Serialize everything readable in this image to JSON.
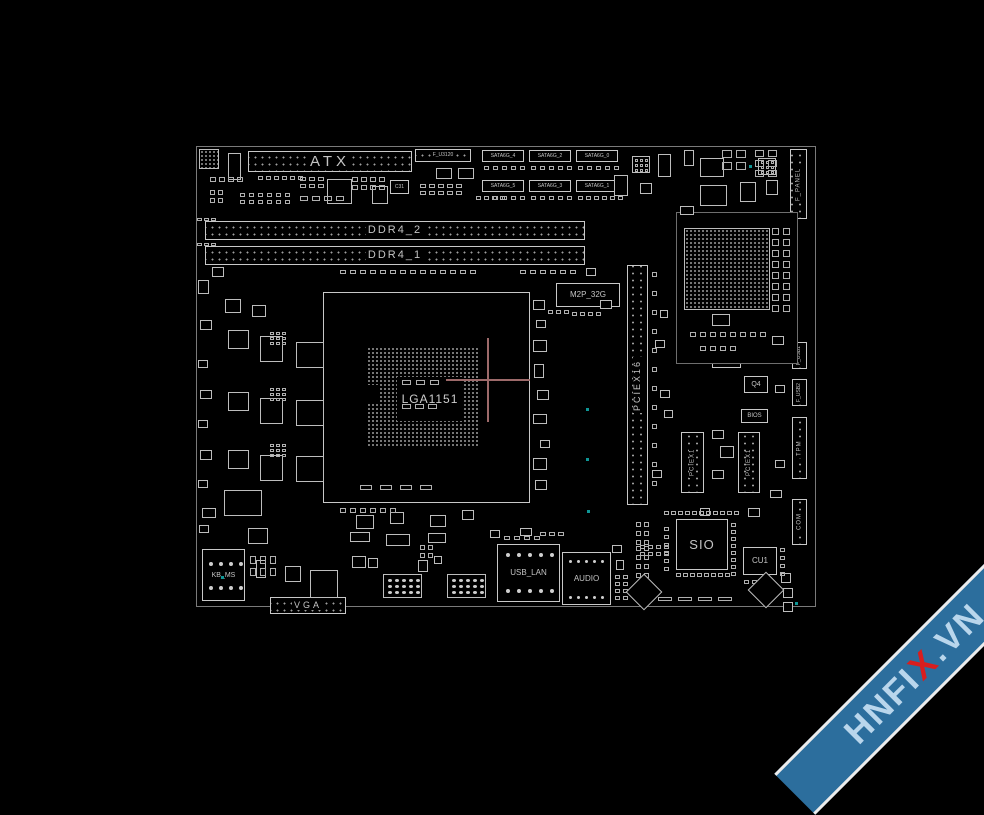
{
  "socket": {
    "label": "LGA1151"
  },
  "watermark": {
    "pre": "HNFI",
    "x": "X",
    "post": ".VN"
  },
  "crosshair": {
    "x": 488,
    "y": 380,
    "arm": 42
  },
  "colors": {
    "background": "#000000",
    "line": "#c8c8c8",
    "dim_line": "#7a7a7a",
    "label": "#c4c4c4",
    "teal": "#0e9696",
    "crosshair": "#9d6a6a",
    "banner": "#2c6e9d",
    "banner_text": "#b9d6ec",
    "banner_x": "#d81e1e",
    "banner_edge": "#ececec"
  },
  "components": [
    {
      "n": "atx-connector",
      "l": "ATX",
      "x": 248,
      "y": 151,
      "w": 164,
      "h": 21,
      "fs": 15,
      "ls": 4,
      "k": "h"
    },
    {
      "n": "f-u3120-header",
      "l": "F_U3120",
      "x": 415,
      "y": 149,
      "w": 56,
      "h": 13,
      "fs": 5,
      "ls": 0,
      "k": "h"
    },
    {
      "n": "sata6g-4-connector",
      "l": "SATA6G_4",
      "x": 482,
      "y": 150,
      "w": 42,
      "h": 12,
      "fs": 5,
      "ls": 0,
      "k": "t"
    },
    {
      "n": "sata6g-2-connector",
      "l": "SATA6G_2",
      "x": 529,
      "y": 150,
      "w": 42,
      "h": 12,
      "fs": 5,
      "ls": 0,
      "k": "t"
    },
    {
      "n": "sata6g-0-connector",
      "l": "SATA6G_0",
      "x": 576,
      "y": 150,
      "w": 42,
      "h": 12,
      "fs": 5,
      "ls": 0,
      "k": "t"
    },
    {
      "n": "sata6g-5-connector",
      "l": "SATA6G_5",
      "x": 482,
      "y": 180,
      "w": 42,
      "h": 12,
      "fs": 5,
      "ls": 0,
      "k": "t"
    },
    {
      "n": "sata6g-3-connector",
      "l": "SATA6G_3",
      "x": 529,
      "y": 180,
      "w": 42,
      "h": 12,
      "fs": 5,
      "ls": 0,
      "k": "t"
    },
    {
      "n": "sata6g-1-connector",
      "l": "SATA6G_1",
      "x": 576,
      "y": 180,
      "w": 42,
      "h": 12,
      "fs": 5,
      "ls": 0,
      "k": "t"
    },
    {
      "n": "ddr4-2-slot",
      "l": "DDR4_2",
      "x": 205,
      "y": 221,
      "w": 380,
      "h": 19,
      "fs": 11,
      "ls": 2,
      "k": "h"
    },
    {
      "n": "ddr4-1-slot",
      "l": "DDR4_1",
      "x": 205,
      "y": 246,
      "w": 380,
      "h": 19,
      "fs": 11,
      "ls": 2,
      "k": "h"
    },
    {
      "n": "m2p-32g-slot",
      "l": "M2P_32G",
      "x": 556,
      "y": 283,
      "w": 64,
      "h": 24,
      "fs": 8,
      "ls": 0,
      "k": "c"
    },
    {
      "n": "pciex16-slot",
      "l": "PCIEX16",
      "x": 627,
      "y": 265,
      "w": 21,
      "h": 240,
      "fs": 9,
      "ls": 2,
      "k": "v"
    },
    {
      "n": "pciex1-1-slot",
      "l": "PCIEX1",
      "x": 681,
      "y": 432,
      "w": 23,
      "h": 61,
      "fs": 6,
      "ls": 1,
      "k": "v"
    },
    {
      "n": "pciex1-2-slot",
      "l": "PCIEX1",
      "x": 738,
      "y": 432,
      "w": 22,
      "h": 61,
      "fs": 6,
      "ls": 1,
      "k": "v"
    },
    {
      "n": "nx2-chip",
      "l": "NX2",
      "x": 712,
      "y": 344,
      "w": 29,
      "h": 24,
      "fs": 7,
      "ls": 0,
      "k": "c"
    },
    {
      "n": "q4-component",
      "l": "Q4",
      "x": 744,
      "y": 376,
      "w": 24,
      "h": 17,
      "fs": 7,
      "ls": 0,
      "k": "c"
    },
    {
      "n": "bios-chip",
      "l": "BIOS",
      "x": 741,
      "y": 409,
      "w": 27,
      "h": 14,
      "fs": 6,
      "ls": 0,
      "k": "c"
    },
    {
      "n": "f-panel-header",
      "l": "F_PANEL",
      "x": 790,
      "y": 149,
      "w": 17,
      "h": 70,
      "fs": 6,
      "ls": 1,
      "k": "v"
    },
    {
      "n": "f-usb1-header",
      "l": "F_USB1",
      "x": 792,
      "y": 342,
      "w": 15,
      "h": 27,
      "fs": 5,
      "ls": 0,
      "k": "v"
    },
    {
      "n": "f-usb2-header",
      "l": "F_USB2",
      "x": 792,
      "y": 379,
      "w": 15,
      "h": 27,
      "fs": 5,
      "ls": 0,
      "k": "v"
    },
    {
      "n": "tpm-header",
      "l": "TPM",
      "x": 792,
      "y": 417,
      "w": 15,
      "h": 62,
      "fs": 6,
      "ls": 1,
      "k": "v"
    },
    {
      "n": "com-header",
      "l": "COM",
      "x": 792,
      "y": 499,
      "w": 15,
      "h": 46,
      "fs": 6,
      "ls": 1,
      "k": "v"
    },
    {
      "n": "sio-chip",
      "l": "SIO",
      "x": 676,
      "y": 519,
      "w": 52,
      "h": 51,
      "fs": 13,
      "ls": 1,
      "k": "c"
    },
    {
      "n": "cu1-chip",
      "l": "CU1",
      "x": 743,
      "y": 547,
      "w": 34,
      "h": 28,
      "fs": 8,
      "ls": 0,
      "k": "c"
    },
    {
      "n": "kb-ms-connector",
      "l": "KB_MS",
      "x": 202,
      "y": 549,
      "w": 43,
      "h": 52,
      "fs": 7,
      "ls": 0,
      "k": "c"
    },
    {
      "n": "vga-connector",
      "l": "VGA",
      "x": 270,
      "y": 597,
      "w": 76,
      "h": 17,
      "fs": 9,
      "ls": 3,
      "k": "h"
    },
    {
      "n": "usb-lan-connector",
      "l": "USB_LAN",
      "x": 497,
      "y": 544,
      "w": 63,
      "h": 58,
      "fs": 8,
      "ls": 0,
      "k": "c"
    },
    {
      "n": "audio-connector",
      "l": "AUDIO",
      "x": 562,
      "y": 552,
      "w": 49,
      "h": 53,
      "fs": 8,
      "ls": 0,
      "k": "c"
    },
    {
      "n": "c31-component",
      "l": "C31",
      "x": 390,
      "y": 180,
      "w": 19,
      "h": 14,
      "fs": 5,
      "ls": 0,
      "k": "c"
    }
  ],
  "filler": {
    "boxes": [
      [
        199,
        149,
        20,
        20,
        2
      ],
      [
        228,
        153,
        13,
        27,
        0
      ],
      [
        327,
        179,
        25,
        25,
        0
      ],
      [
        372,
        186,
        16,
        18,
        0
      ],
      [
        436,
        168,
        16,
        11,
        0
      ],
      [
        458,
        168,
        16,
        11,
        0
      ],
      [
        614,
        175,
        14,
        21,
        0
      ],
      [
        640,
        183,
        12,
        11,
        0
      ],
      [
        658,
        154,
        13,
        23,
        0
      ],
      [
        632,
        156,
        18,
        17,
        0
      ],
      [
        758,
        158,
        18,
        17,
        0
      ],
      [
        700,
        158,
        24,
        19,
        0
      ],
      [
        740,
        182,
        16,
        20,
        0
      ],
      [
        766,
        180,
        12,
        15,
        0
      ],
      [
        700,
        185,
        27,
        21,
        0
      ],
      [
        676,
        212,
        122,
        152,
        1
      ],
      [
        684,
        228,
        86,
        82,
        2
      ],
      [
        712,
        314,
        18,
        12,
        0
      ],
      [
        680,
        206,
        14,
        9,
        0
      ],
      [
        212,
        267,
        12,
        10,
        0
      ],
      [
        198,
        280,
        11,
        14,
        0
      ],
      [
        225,
        299,
        16,
        14,
        0
      ],
      [
        252,
        305,
        14,
        12,
        0
      ],
      [
        228,
        330,
        21,
        19,
        0
      ],
      [
        260,
        336,
        23,
        26,
        0
      ],
      [
        296,
        342,
        28,
        26,
        0
      ],
      [
        228,
        392,
        21,
        19,
        0
      ],
      [
        260,
        398,
        23,
        26,
        0
      ],
      [
        296,
        400,
        28,
        26,
        0
      ],
      [
        228,
        450,
        21,
        19,
        0
      ],
      [
        260,
        455,
        23,
        26,
        0
      ],
      [
        296,
        456,
        28,
        26,
        0
      ],
      [
        224,
        490,
        38,
        26,
        0
      ],
      [
        248,
        528,
        20,
        16,
        0
      ],
      [
        310,
        570,
        28,
        28,
        0
      ],
      [
        533,
        300,
        12,
        10,
        0
      ],
      [
        536,
        320,
        10,
        8,
        0
      ],
      [
        533,
        340,
        14,
        12,
        0
      ],
      [
        534,
        364,
        10,
        14,
        0
      ],
      [
        537,
        390,
        12,
        10,
        0
      ],
      [
        533,
        414,
        14,
        10,
        0
      ],
      [
        540,
        440,
        10,
        8,
        0
      ],
      [
        533,
        458,
        14,
        12,
        0
      ],
      [
        535,
        480,
        12,
        10,
        0
      ],
      [
        356,
        515,
        18,
        14,
        0
      ],
      [
        390,
        512,
        14,
        12,
        0
      ],
      [
        430,
        515,
        16,
        12,
        0
      ],
      [
        462,
        510,
        12,
        10,
        0
      ],
      [
        350,
        532,
        20,
        10,
        0
      ],
      [
        386,
        534,
        24,
        12,
        0
      ],
      [
        428,
        533,
        18,
        10,
        0
      ],
      [
        660,
        390,
        10,
        8,
        0
      ],
      [
        664,
        410,
        9,
        8,
        0
      ],
      [
        652,
        470,
        10,
        8,
        0
      ],
      [
        712,
        430,
        12,
        9,
        0
      ],
      [
        712,
        470,
        12,
        9,
        0
      ],
      [
        720,
        446,
        14,
        12,
        0
      ],
      [
        612,
        545,
        10,
        8,
        0
      ],
      [
        616,
        560,
        8,
        10,
        0
      ],
      [
        490,
        530,
        10,
        8,
        0
      ],
      [
        520,
        528,
        12,
        8,
        0
      ],
      [
        285,
        566,
        16,
        16,
        0
      ],
      [
        256,
        560,
        10,
        18,
        0
      ],
      [
        352,
        556,
        14,
        12,
        0
      ],
      [
        368,
        558,
        10,
        10,
        0
      ],
      [
        418,
        560,
        10,
        12,
        0
      ],
      [
        434,
        556,
        8,
        8,
        0
      ],
      [
        781,
        573,
        10,
        10,
        0
      ],
      [
        783,
        588,
        10,
        10,
        0
      ],
      [
        783,
        602,
        10,
        10,
        0
      ],
      [
        684,
        150,
        10,
        16,
        0
      ],
      [
        200,
        320,
        12,
        10,
        0
      ],
      [
        198,
        360,
        10,
        8,
        0
      ],
      [
        200,
        390,
        12,
        9,
        0
      ],
      [
        198,
        420,
        10,
        8,
        0
      ],
      [
        200,
        450,
        12,
        10,
        0
      ],
      [
        198,
        480,
        10,
        8,
        0
      ],
      [
        202,
        508,
        14,
        10,
        0
      ],
      [
        199,
        525,
        10,
        8,
        0
      ],
      [
        586,
        268,
        10,
        8,
        0
      ],
      [
        600,
        300,
        12,
        9,
        0
      ],
      [
        655,
        340,
        10,
        8,
        0
      ],
      [
        660,
        310,
        8,
        8,
        0
      ],
      [
        772,
        336,
        12,
        9,
        0
      ],
      [
        775,
        385,
        10,
        8,
        0
      ],
      [
        775,
        460,
        10,
        8,
        0
      ],
      [
        770,
        490,
        12,
        8,
        0
      ],
      [
        748,
        508,
        12,
        9,
        0
      ],
      [
        700,
        508,
        10,
        8,
        0
      ],
      [
        383,
        574,
        39,
        24,
        0
      ],
      [
        447,
        574,
        39,
        24,
        0
      ]
    ],
    "grids": [
      [
        210,
        177,
        4,
        1,
        6,
        5,
        3,
        0,
        0
      ],
      [
        258,
        176,
        6,
        1,
        5,
        4,
        3,
        0,
        0
      ],
      [
        300,
        177,
        3,
        2,
        6,
        4,
        3,
        3,
        0
      ],
      [
        210,
        190,
        2,
        2,
        5,
        5,
        3,
        3,
        0
      ],
      [
        240,
        193,
        6,
        2,
        5,
        4,
        4,
        3,
        0
      ],
      [
        300,
        196,
        4,
        1,
        8,
        5,
        4,
        0,
        0
      ],
      [
        352,
        177,
        4,
        2,
        6,
        5,
        3,
        3,
        0
      ],
      [
        420,
        184,
        5,
        2,
        6,
        4,
        3,
        3,
        0
      ],
      [
        476,
        196,
        4,
        1,
        5,
        4,
        3,
        0,
        0
      ],
      [
        484,
        166,
        5,
        1,
        5,
        4,
        4,
        0,
        0
      ],
      [
        531,
        166,
        5,
        1,
        5,
        4,
        4,
        0,
        0
      ],
      [
        578,
        166,
        5,
        1,
        5,
        4,
        4,
        0,
        0
      ],
      [
        484,
        196,
        5,
        1,
        5,
        4,
        4,
        0,
        0
      ],
      [
        531,
        196,
        5,
        1,
        5,
        4,
        4,
        0,
        0
      ],
      [
        578,
        196,
        6,
        1,
        5,
        4,
        3,
        0,
        0
      ],
      [
        197,
        218,
        3,
        1,
        5,
        3,
        2,
        0,
        0
      ],
      [
        197,
        243,
        3,
        1,
        5,
        3,
        2,
        0,
        0
      ],
      [
        340,
        270,
        14,
        1,
        6,
        4,
        4,
        0,
        0
      ],
      [
        520,
        270,
        6,
        1,
        6,
        4,
        4,
        0,
        0
      ],
      [
        270,
        332,
        3,
        3,
        4,
        3,
        2,
        2,
        0
      ],
      [
        270,
        388,
        3,
        3,
        4,
        3,
        2,
        2,
        0
      ],
      [
        270,
        444,
        3,
        3,
        4,
        3,
        2,
        2,
        0
      ],
      [
        360,
        485,
        4,
        1,
        12,
        5,
        8,
        0,
        0
      ],
      [
        340,
        508,
        6,
        1,
        6,
        5,
        4,
        0,
        0
      ],
      [
        548,
        310,
        3,
        1,
        5,
        4,
        3,
        0,
        0
      ],
      [
        572,
        312,
        4,
        1,
        5,
        4,
        3,
        0,
        0
      ],
      [
        652,
        272,
        1,
        12,
        5,
        5,
        0,
        14,
        0
      ],
      [
        772,
        228,
        2,
        8,
        7,
        7,
        4,
        4,
        0
      ],
      [
        690,
        332,
        8,
        1,
        6,
        5,
        4,
        0,
        0
      ],
      [
        700,
        346,
        4,
        1,
        6,
        5,
        4,
        0,
        0
      ],
      [
        755,
        150,
        2,
        3,
        9,
        7,
        4,
        3,
        0
      ],
      [
        722,
        150,
        2,
        2,
        10,
        8,
        4,
        4,
        0
      ],
      [
        635,
        159,
        3,
        3,
        3,
        3,
        2,
        2,
        0
      ],
      [
        761,
        161,
        3,
        3,
        3,
        3,
        2,
        2,
        0
      ],
      [
        664,
        511,
        11,
        1,
        5,
        4,
        2,
        0,
        0
      ],
      [
        664,
        527,
        1,
        6,
        5,
        4,
        0,
        4,
        0
      ],
      [
        731,
        523,
        1,
        8,
        5,
        4,
        0,
        3,
        0
      ],
      [
        676,
        573,
        8,
        1,
        5,
        4,
        2,
        0,
        0
      ],
      [
        636,
        522,
        2,
        3,
        5,
        5,
        3,
        4,
        0
      ],
      [
        636,
        546,
        2,
        4,
        5,
        5,
        3,
        4,
        0
      ],
      [
        658,
        597,
        4,
        1,
        14,
        4,
        6,
        0,
        0
      ],
      [
        780,
        548,
        1,
        4,
        5,
        4,
        0,
        4,
        0
      ],
      [
        744,
        580,
        4,
        1,
        5,
        4,
        3,
        0,
        0
      ],
      [
        209,
        562,
        4,
        1,
        4,
        4,
        6,
        0,
        1
      ],
      [
        209,
        586,
        4,
        1,
        4,
        4,
        6,
        0,
        1
      ],
      [
        388,
        579,
        5,
        3,
        4,
        3,
        3,
        3,
        1
      ],
      [
        452,
        579,
        5,
        3,
        4,
        3,
        3,
        3,
        1
      ],
      [
        506,
        553,
        5,
        1,
        4,
        4,
        7,
        0,
        1
      ],
      [
        506,
        589,
        5,
        1,
        4,
        4,
        7,
        0,
        1
      ],
      [
        504,
        536,
        4,
        1,
        6,
        4,
        4,
        0,
        0
      ],
      [
        569,
        560,
        5,
        1,
        3,
        3,
        5,
        0,
        1
      ],
      [
        569,
        596,
        5,
        1,
        3,
        3,
        5,
        0,
        1
      ],
      [
        250,
        556,
        3,
        2,
        6,
        8,
        4,
        4,
        0
      ],
      [
        420,
        545,
        2,
        2,
        5,
        5,
        3,
        3,
        0
      ],
      [
        615,
        575,
        2,
        4,
        5,
        4,
        3,
        3,
        0
      ],
      [
        640,
        545,
        4,
        2,
        5,
        4,
        3,
        3,
        0
      ],
      [
        540,
        532,
        3,
        1,
        6,
        4,
        3,
        0,
        0
      ],
      [
        402,
        380,
        3,
        1,
        9,
        5,
        5,
        0,
        0
      ],
      [
        402,
        404,
        3,
        1,
        9,
        5,
        4,
        0,
        0
      ]
    ],
    "diamonds": [
      [
        644,
        592,
        26
      ],
      [
        766,
        590,
        26
      ]
    ],
    "teal_dots": [
      [
        586,
        408
      ],
      [
        586,
        458
      ],
      [
        587,
        510
      ],
      [
        221,
        576
      ],
      [
        795,
        602
      ],
      [
        749,
        165
      ]
    ]
  }
}
